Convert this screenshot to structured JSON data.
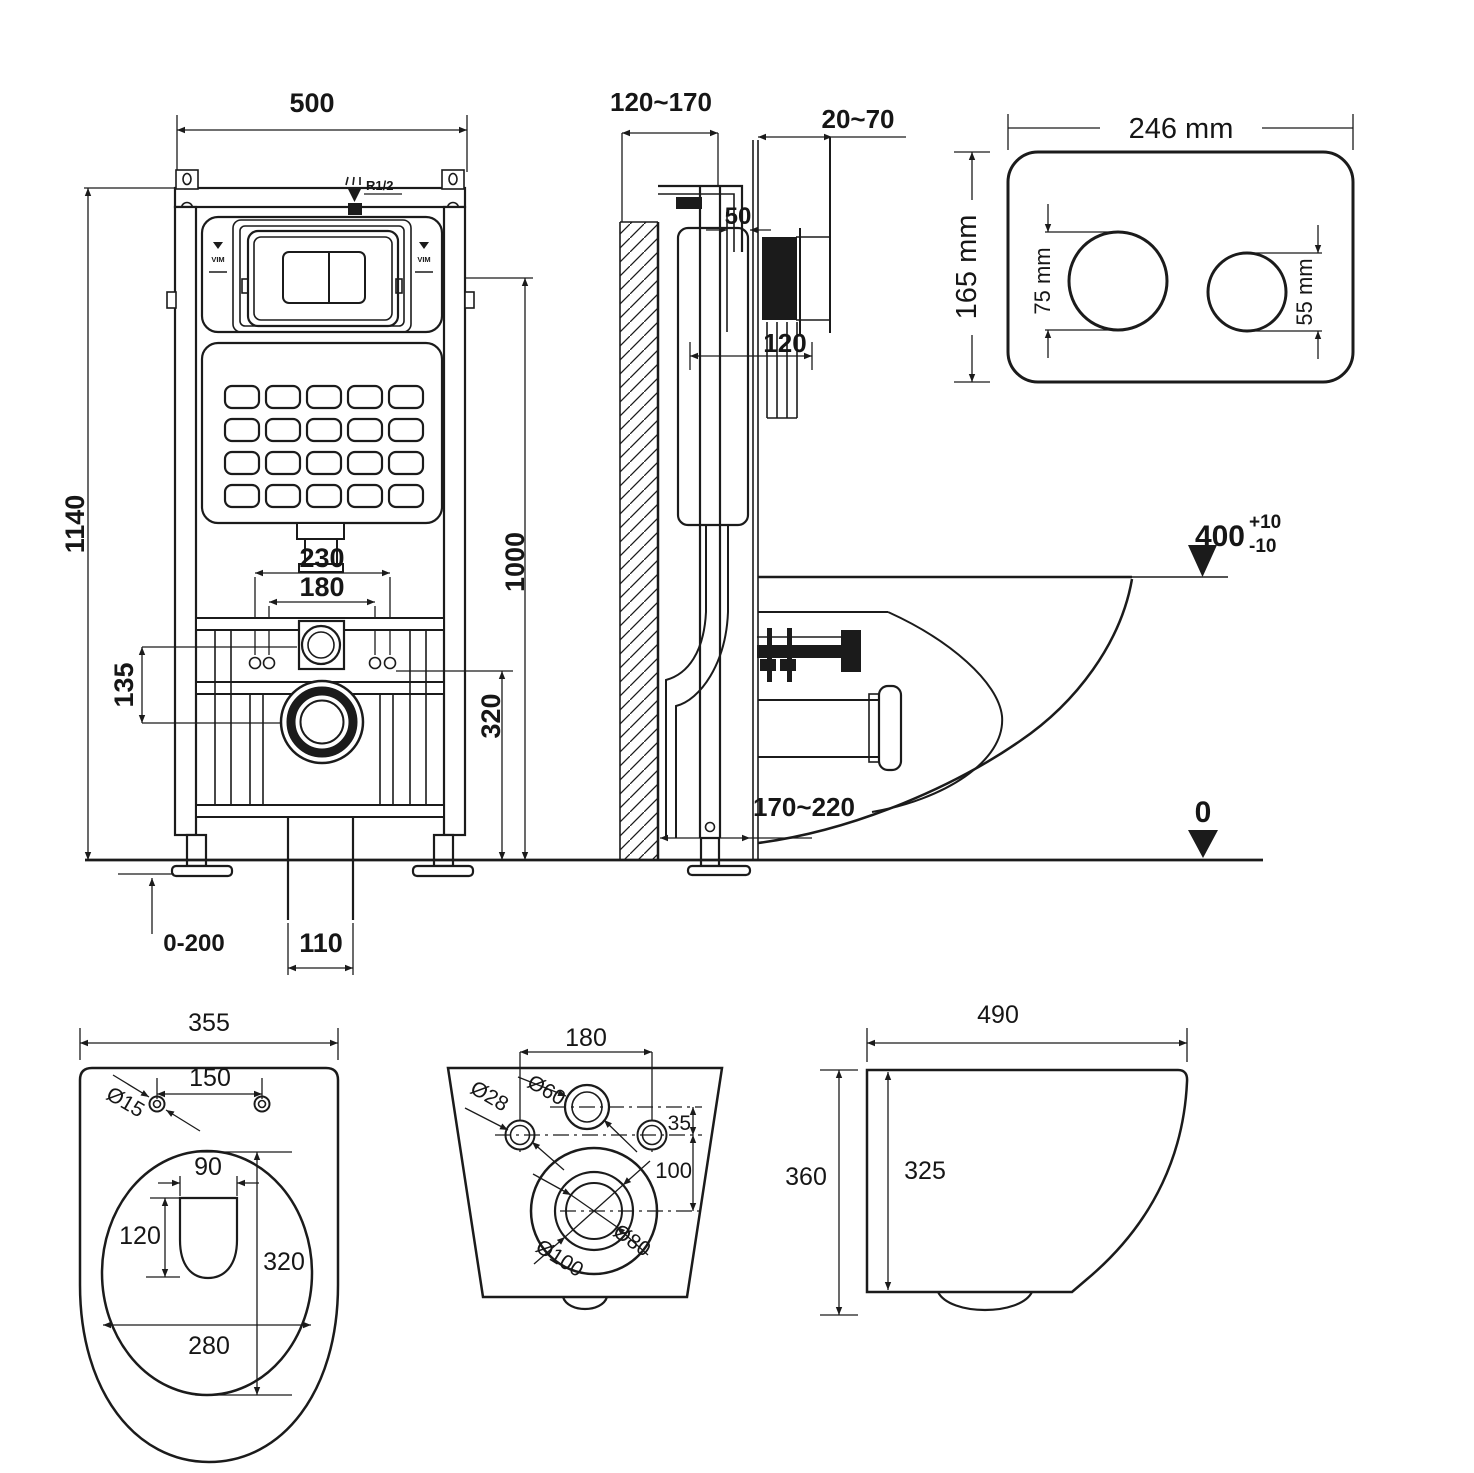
{
  "views": {
    "frame_front": {
      "width": "500",
      "height": "1140",
      "plate_height": "1000",
      "supply": "R1/2",
      "brand_mark": "VIM",
      "outlet_pipe_spacing": "230",
      "fixing_spacing": "180",
      "inlet_offset": "135",
      "outlet_height": "320",
      "duct_width": "110",
      "foot_adjust": "0-200"
    },
    "frame_side": {
      "install_depth": "120~170",
      "finish_thickness": "20~70",
      "plate_depth": "50",
      "frame_depth": "120",
      "drain_offset": "170~220",
      "seat_level": "400",
      "seat_level_tol_plus": "+10",
      "seat_level_tol_minus": "-10",
      "floor_level": "0"
    },
    "flush_plate": {
      "width": "246 mm",
      "height": "165 mm",
      "big_button": "75 mm",
      "small_button": "55 mm"
    },
    "bowl_top": {
      "width": "355",
      "seat_hole_spacing": "150",
      "seat_hole_dia": "Ø15",
      "flush_opening_width": "90",
      "flush_opening_depth": "120",
      "bowl_opening_length": "320",
      "bowl_opening_width": "280"
    },
    "bowl_rear": {
      "fixing_spacing": "180",
      "fixing_dia": "Ø28",
      "inlet_dia": "Ø60",
      "inlet_offset": "35",
      "outlet_drop": "100",
      "outlet_dia_inner": "Ø80",
      "outlet_dia_outer": "Ø100"
    },
    "bowl_side": {
      "depth": "490",
      "height": "360",
      "inner_height": "325"
    }
  }
}
